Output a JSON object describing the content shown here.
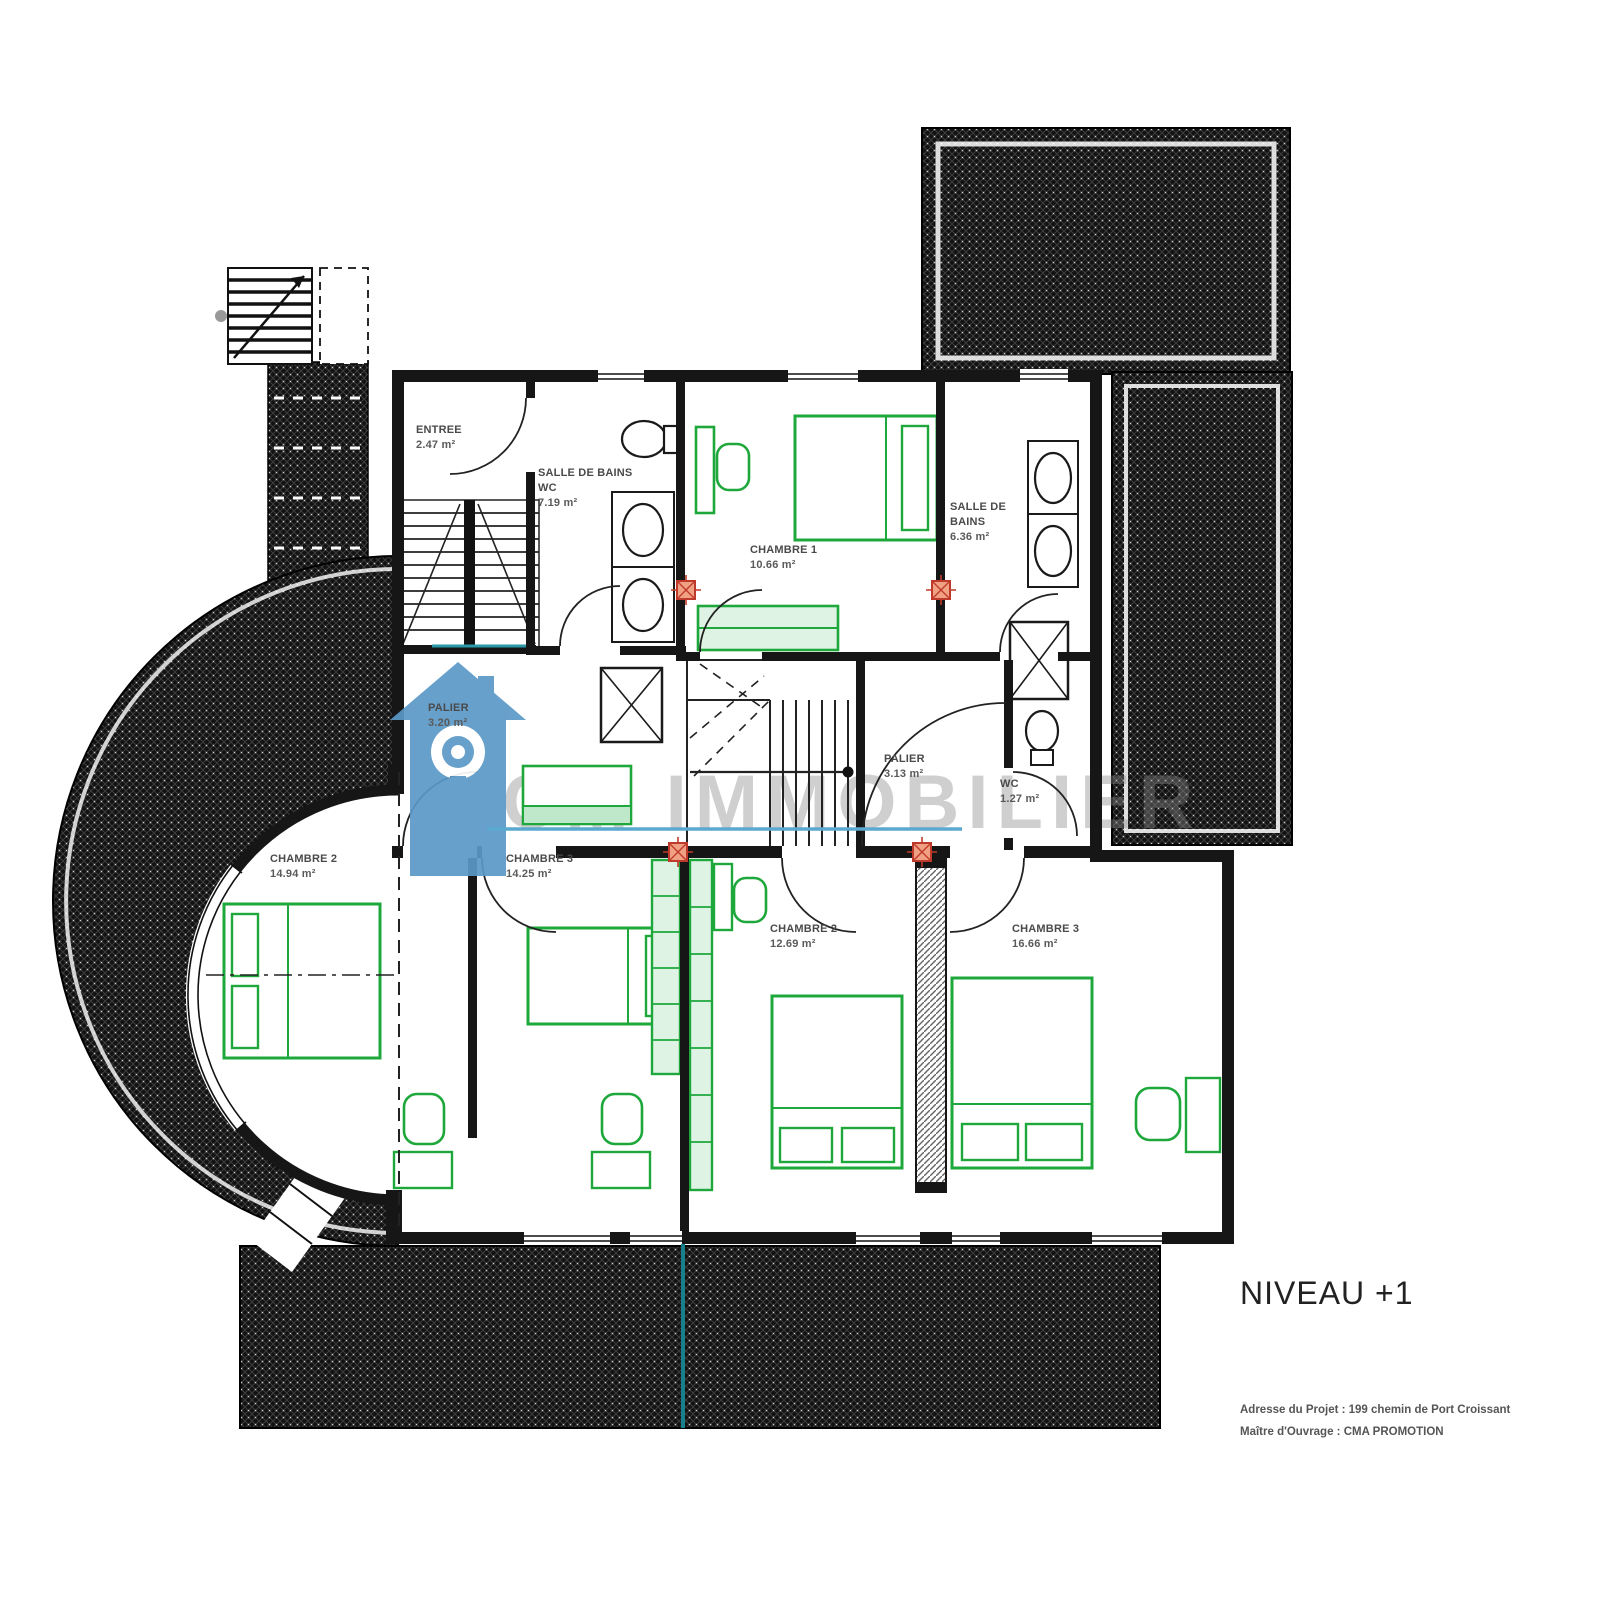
{
  "level_title": "NIVEAU +1",
  "project_info": {
    "address": "Adresse du Projet : 199 chemin de Port Croissant",
    "owner": "Maître d'Ouvrage : CMA PROMOTION"
  },
  "watermark": {
    "text": "CM IMMOBILIER"
  },
  "rooms": [
    {
      "key": "entree",
      "name": "ENTREE",
      "area": "2.47 m²"
    },
    {
      "key": "salle-de-bains-wc",
      "name": "SALLE DE BAINS",
      "name2": "WC",
      "area": "7.19 m²"
    },
    {
      "key": "chambre-1",
      "name": "CHAMBRE 1",
      "area": "10.66 m²"
    },
    {
      "key": "salle-de-bains",
      "name": "SALLE DE BAINS",
      "area": "6.36 m²"
    },
    {
      "key": "palier-gauche",
      "name": "PALIER",
      "area": "3.20 m²"
    },
    {
      "key": "palier-droit",
      "name": "PALIER",
      "area": "3.13 m²"
    },
    {
      "key": "wc",
      "name": "WC",
      "area": "1.27 m²"
    },
    {
      "key": "chambre-2-gauche",
      "name": "CHAMBRE 2",
      "area": "14.94 m²"
    },
    {
      "key": "chambre-3-gauche",
      "name": "CHAMBRE 3",
      "area": "14.25 m²"
    },
    {
      "key": "chambre-2-bas",
      "name": "CHAMBRE 2",
      "area": "12.69 m²"
    },
    {
      "key": "chambre-3-droit",
      "name": "CHAMBRE 3",
      "area": "16.66 m²"
    }
  ],
  "colors": {
    "furniture_green": "#1ea83c",
    "wall_black": "#161616",
    "hatch_dark": "#121212",
    "marker_red": "#c03a2b",
    "watermark_blue": "#5b99c7",
    "utility_teal": "#17808d",
    "watermark_underline_blue": "#5aa9cf"
  }
}
